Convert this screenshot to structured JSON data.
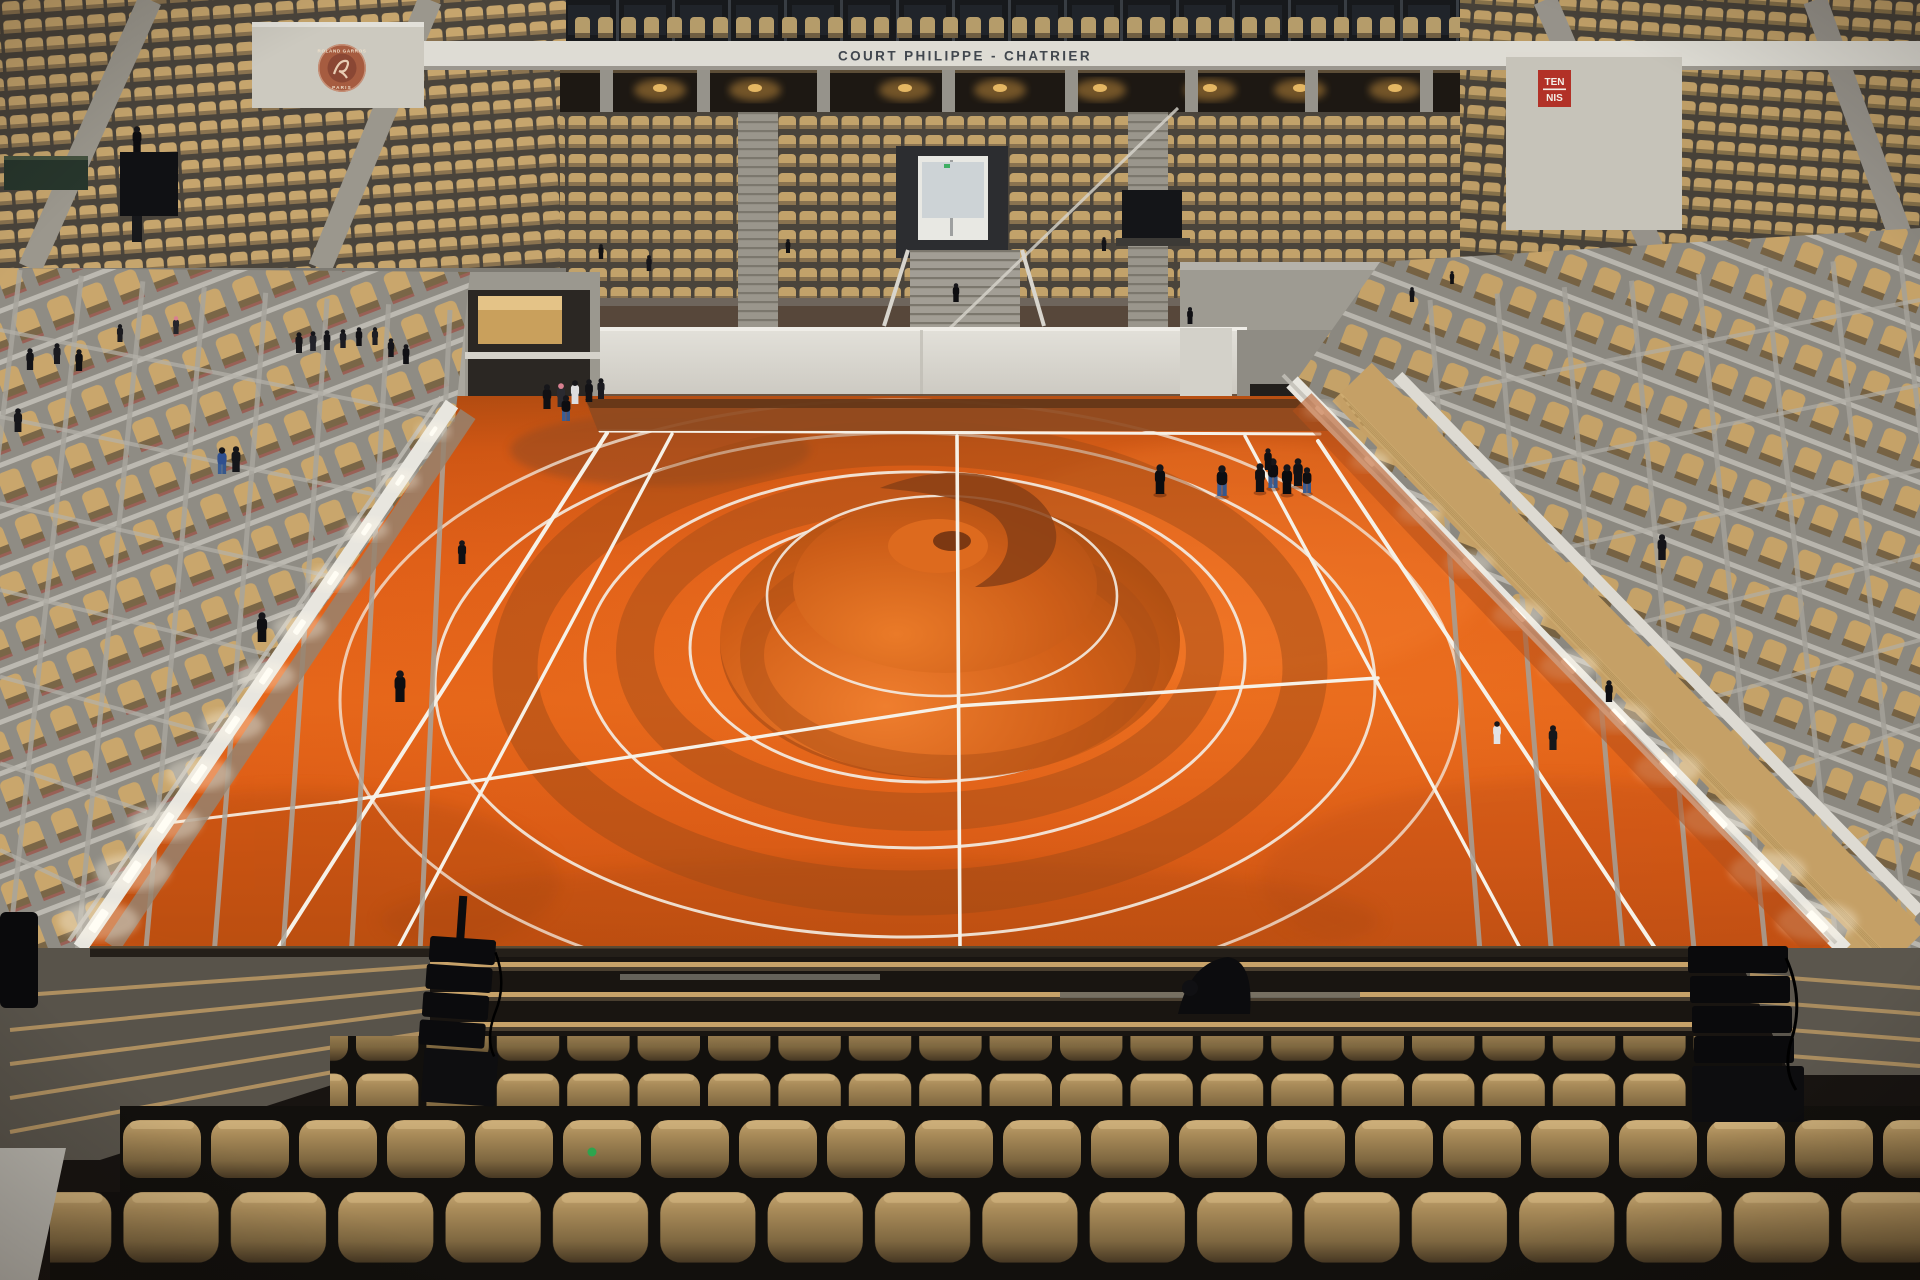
{
  "scene": {
    "description": "Indoor view of an empty tennis stadium with beige seats; orange clay court carved with a giant circular land-art mound; visitors walking on court and concourses",
    "venue": "Court Philippe-Chatrier"
  },
  "signs": {
    "venue_banner": "COURT PHILIPPE - CHATRIER",
    "logo_ring_text": "ROLAND GARROS",
    "logo_bottom_text": "PARIS",
    "tennis_sign_top": "TEN",
    "tennis_sign_bottom": "NIS"
  },
  "palette": {
    "clay_orange": "#e0601a",
    "clay_shadow": "#9c4a16",
    "seat_tan": "#c2a26a",
    "wall_white": "#d8d6ce",
    "box_gray": "#8f8c84",
    "sign_red": "#b23127",
    "banner_white": "#dedcd4",
    "dark_glass": "#17191c",
    "accent_green": "#2da44e"
  }
}
